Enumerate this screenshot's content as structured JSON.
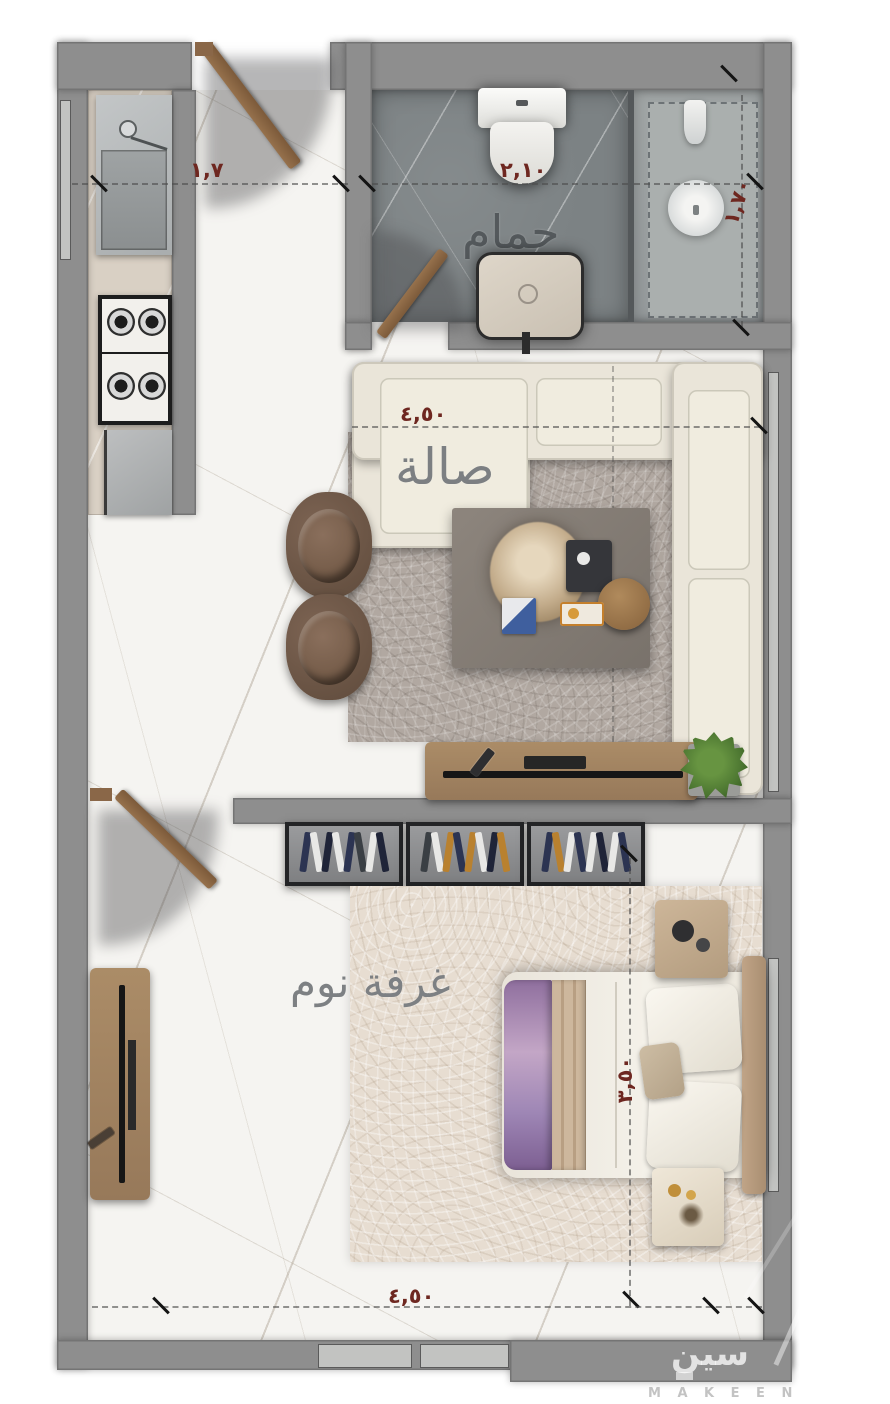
{
  "rooms": {
    "bathroom": {
      "label": "حمام"
    },
    "living_room": {
      "label": "صالة"
    },
    "bedroom": {
      "label": "غرفة نوم"
    }
  },
  "dimensions": {
    "entry_width": "١,٧",
    "bathroom_width": "٢,١٠",
    "shower_depth": "١,٧٠",
    "living_width": "٤,٥٠",
    "bedroom_depth": "٣,٥٠",
    "bedroom_width": "٤,٥٠"
  },
  "watermark": {
    "arabic": "سين",
    "latin": "M A K E E N"
  },
  "colors": {
    "wall": "#8e8e8e",
    "floor": "#f5f4f1",
    "kitchen_counter": "#d9d0c4",
    "bath_floor": "#7c8284",
    "shower_floor": "#9aa0a1",
    "rug_living": "#b1a8a1",
    "rug_bedroom": "#e7ddd1",
    "sofa": "#eae5d9",
    "armchair": "#6e5646",
    "wood": "#a08262",
    "bed": "#f0ece4",
    "throw_purple": "#8f6f9e",
    "dim_text": "#6e2720",
    "room_label": "#5e6366",
    "plant_green": "#4c7631",
    "wardrobe_dark": "#232426"
  }
}
